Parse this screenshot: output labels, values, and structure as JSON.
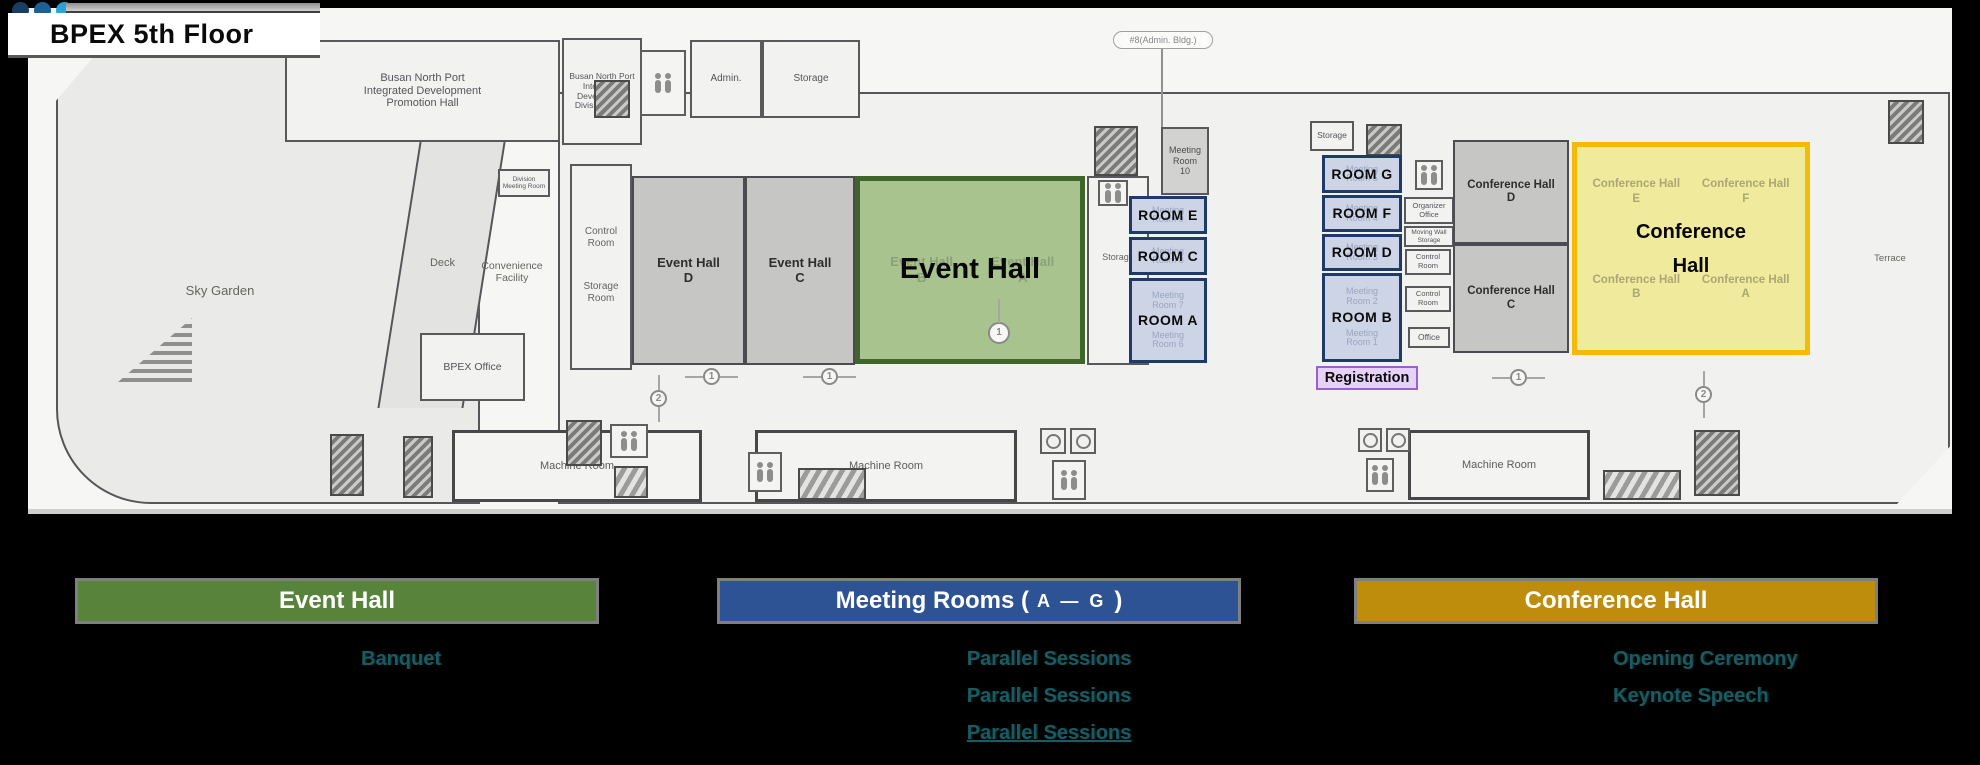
{
  "header": {
    "title": "BPEX 5th Floor",
    "dot_colors": [
      "#1a3e63",
      "#1f5f97",
      "#2da0d8"
    ]
  },
  "plan": {
    "items": [
      {
        "t": "room",
        "n": "promotion-hall",
        "x": 285,
        "y": 40,
        "w": 275,
        "h": 102,
        "fz": 11,
        "label": "Busan North Port\nIntegrated Development\nPromotion Hall"
      },
      {
        "t": "room",
        "n": "division-office",
        "v": "",
        "x": 562,
        "y": 38,
        "w": 80,
        "h": 107,
        "fz": 8.5,
        "label": "Busan North Port\nIntegrated\nDevelopment\nDivision Office"
      },
      {
        "t": "icon",
        "n": "stairs-icon",
        "v": "stairs",
        "x": 594,
        "y": 80,
        "w": 36,
        "h": 38
      },
      {
        "t": "icon",
        "n": "restroom-icon",
        "v": "restroom",
        "x": 640,
        "y": 50,
        "w": 46,
        "h": 66
      },
      {
        "t": "room",
        "n": "admin-room",
        "x": 690,
        "y": 40,
        "w": 72,
        "h": 78,
        "fz": 10,
        "label": "Admin."
      },
      {
        "t": "room",
        "n": "storage-room-top",
        "x": 762,
        "y": 40,
        "w": 98,
        "h": 78,
        "fz": 10,
        "label": "Storage"
      },
      {
        "t": "callout",
        "n": "admin-bldg-callout",
        "x": 1113,
        "y": 31,
        "w": 100,
        "h": 18,
        "fz": 9,
        "label": "#8(Admin. Bldg.)"
      },
      {
        "t": "vline",
        "n": "callout-line",
        "x": 1161,
        "y": 49,
        "w": 2,
        "h": 79
      },
      {
        "t": "room",
        "n": "division-meeting-room",
        "x": 498,
        "y": 169,
        "w": 52,
        "h": 28,
        "fz": 6.5,
        "label": "Division\nMeeting Room"
      },
      {
        "t": "room",
        "n": "control-storage-block",
        "x": 570,
        "y": 164,
        "w": 62,
        "h": 206,
        "fz": 10,
        "label": ""
      },
      {
        "t": "label",
        "n": "control-room-label",
        "x": 572,
        "y": 226,
        "w": 58,
        "fz": 10,
        "label": "Control\nRoom"
      },
      {
        "t": "label",
        "n": "storage-room-label",
        "x": 572,
        "y": 281,
        "w": 58,
        "fz": 10,
        "label": "Storage\nRoom"
      },
      {
        "t": "room",
        "n": "bpex-office",
        "x": 420,
        "y": 333,
        "w": 105,
        "h": 68,
        "fz": 10.5,
        "label": "BPEX Office"
      },
      {
        "t": "label",
        "n": "sky-garden-label",
        "x": 160,
        "y": 284,
        "w": 120,
        "fz": 13,
        "label": "Sky Garden"
      },
      {
        "t": "label",
        "n": "deck-label",
        "x": 415,
        "y": 257,
        "w": 55,
        "fz": 11,
        "label": "Deck"
      },
      {
        "t": "label",
        "n": "convenience-facility-label",
        "x": 462,
        "y": 260,
        "w": 100,
        "fz": 10.5,
        "label": "Convenience\nFacility"
      },
      {
        "t": "room",
        "n": "event-hall-d",
        "v": "gray",
        "x": 632,
        "y": 176,
        "w": 113,
        "h": 189,
        "fz": 13,
        "label": "Event Hall\nD"
      },
      {
        "t": "room",
        "n": "event-hall-c",
        "v": "gray",
        "x": 745,
        "y": 176,
        "w": 110,
        "h": 189,
        "fz": 13,
        "label": "Event Hall\nC"
      },
      {
        "t": "room",
        "n": "storage-mid-room",
        "x": 1087,
        "y": 176,
        "w": 62,
        "h": 189,
        "fz": 9,
        "label": ""
      },
      {
        "t": "label",
        "n": "storage-mid-label",
        "x": 1090,
        "y": 252,
        "w": 56,
        "fz": 9,
        "label": "Storage"
      },
      {
        "t": "overlay",
        "v": "green",
        "n": "event-hall-overlay",
        "x": 855,
        "y": 176,
        "w": 230,
        "h": 188,
        "main": "Event Hall",
        "ghosts": [
          {
            "text": "Event Hall\nB",
            "px": 6,
            "pw": 44
          },
          {
            "text": "Event Hall\nA",
            "px": 52,
            "pw": 44
          }
        ]
      },
      {
        "t": "icon",
        "n": "stairs-icon",
        "v": "stairs",
        "x": 1094,
        "y": 126,
        "w": 44,
        "h": 50
      },
      {
        "t": "icon",
        "n": "elevator-icon",
        "v": "restroom",
        "x": 1098,
        "y": 180,
        "w": 30,
        "h": 26
      },
      {
        "t": "room",
        "n": "meeting-room-10",
        "v": "mid",
        "x": 1161,
        "y": 127,
        "w": 48,
        "h": 68,
        "fz": 9,
        "label": "Meeting\nRoom\n10"
      },
      {
        "t": "roombox",
        "n": "room-e-overlay",
        "x": 1129,
        "y": 196,
        "w": 78,
        "h": 38,
        "label": "ROOM E",
        "ghosts": [
          "Meeting Room 9"
        ]
      },
      {
        "t": "roombox",
        "n": "room-c-overlay",
        "x": 1129,
        "y": 237,
        "w": 78,
        "h": 38,
        "label": "ROOM C",
        "ghosts": [
          "Meeting Room 8"
        ]
      },
      {
        "t": "roombox",
        "n": "room-a-overlay",
        "x": 1129,
        "y": 278,
        "w": 78,
        "h": 85,
        "label": "ROOM A",
        "ghosts": [
          "Meeting Room 7",
          "Meeting Room 6"
        ]
      },
      {
        "t": "room",
        "n": "storage-small",
        "x": 1310,
        "y": 121,
        "w": 44,
        "h": 30,
        "fz": 8.5,
        "label": "Storage"
      },
      {
        "t": "icon",
        "n": "stairs-icon",
        "v": "stairs",
        "x": 1366,
        "y": 124,
        "w": 36,
        "h": 32
      },
      {
        "t": "icon",
        "n": "restroom-icon",
        "v": "restroom",
        "x": 1415,
        "y": 160,
        "w": 28,
        "h": 30
      },
      {
        "t": "room",
        "n": "organizer-office",
        "x": 1404,
        "y": 197,
        "w": 50,
        "h": 27,
        "fz": 7.5,
        "label": "Organizer\nOffice"
      },
      {
        "t": "room",
        "n": "moving-wall-storage",
        "x": 1404,
        "y": 226,
        "w": 50,
        "h": 21,
        "fz": 6.5,
        "label": "Moving Wall\nStorage"
      },
      {
        "t": "room",
        "n": "control-room-a",
        "x": 1405,
        "y": 249,
        "w": 46,
        "h": 26,
        "fz": 7.5,
        "label": "Control\nRoom"
      },
      {
        "t": "room",
        "n": "control-room-b",
        "x": 1405,
        "y": 286,
        "w": 46,
        "h": 26,
        "fz": 7.5,
        "label": "Control\nRoom"
      },
      {
        "t": "room",
        "n": "office-small",
        "x": 1408,
        "y": 327,
        "w": 42,
        "h": 21,
        "fz": 8.5,
        "label": "Office"
      },
      {
        "t": "roombox",
        "n": "room-g-overlay",
        "x": 1322,
        "y": 155,
        "w": 80,
        "h": 38,
        "label": "ROOM G",
        "ghosts": [
          "Meeting Room 5"
        ]
      },
      {
        "t": "roombox",
        "n": "room-f-overlay",
        "x": 1322,
        "y": 195,
        "w": 80,
        "h": 37,
        "label": "ROOM F",
        "ghosts": [
          "Meeting Room 4"
        ]
      },
      {
        "t": "roombox",
        "n": "room-d-overlay",
        "x": 1322,
        "y": 234,
        "w": 80,
        "h": 37,
        "label": "ROOM D",
        "ghosts": [
          "Meeting Room 3"
        ]
      },
      {
        "t": "roombox",
        "n": "room-b-overlay",
        "x": 1322,
        "y": 273,
        "w": 80,
        "h": 89,
        "label": "ROOM B",
        "ghosts": [
          "Meeting Room 2",
          "Meeting Room 1"
        ]
      },
      {
        "t": "registration",
        "n": "registration-overlay",
        "x": 1316,
        "y": 366,
        "w": 102,
        "h": 24,
        "label": "Registration"
      },
      {
        "t": "room",
        "n": "conference-hall-d",
        "v": "gray",
        "x": 1453,
        "y": 140,
        "w": 116,
        "h": 104,
        "fz": 11.5,
        "label": "Conference Hall\nD"
      },
      {
        "t": "room",
        "n": "conference-hall-c",
        "v": "gray",
        "x": 1453,
        "y": 244,
        "w": 116,
        "h": 109,
        "fz": 11.5,
        "label": "Conference Hall\nC"
      },
      {
        "t": "overlay",
        "v": "yellow",
        "n": "conference-hall-overlay",
        "x": 1572,
        "y": 142,
        "w": 238,
        "h": 213,
        "main": "Conference\nHall",
        "ghosts": [
          {
            "text": "Conference Hall\nE",
            "px": 3,
            "py": 15,
            "pw": 46
          },
          {
            "text": "Conference Hall\nF",
            "px": 51,
            "py": 15,
            "pw": 46
          },
          {
            "text": "Conference Hall\nB",
            "px": 3,
            "py": 62,
            "pw": 46
          },
          {
            "text": "Conference Hall\nA",
            "px": 51,
            "py": 62,
            "pw": 46
          }
        ]
      },
      {
        "t": "label",
        "n": "terrace-label",
        "x": 1855,
        "y": 254,
        "w": 70,
        "fz": 9.5,
        "label": "Terrace"
      },
      {
        "t": "room",
        "n": "machine-room-1",
        "v": "mr",
        "x": 452,
        "y": 430,
        "w": 250,
        "h": 72,
        "fz": 11,
        "label": "Machine Room"
      },
      {
        "t": "room",
        "n": "machine-room-2",
        "v": "mr",
        "x": 755,
        "y": 430,
        "w": 262,
        "h": 72,
        "fz": 11,
        "label": "Machine Room"
      },
      {
        "t": "room",
        "n": "machine-room-3",
        "v": "mr",
        "x": 1408,
        "y": 430,
        "w": 182,
        "h": 70,
        "fz": 11,
        "label": "Machine Room"
      },
      {
        "t": "icon",
        "n": "stairs-icon",
        "v": "stairs",
        "x": 330,
        "y": 434,
        "w": 34,
        "h": 62
      },
      {
        "t": "icon",
        "n": "stairs-icon",
        "v": "stairs",
        "x": 403,
        "y": 436,
        "w": 30,
        "h": 62
      },
      {
        "t": "icon",
        "n": "elevator-icon",
        "v": "stairs",
        "x": 566,
        "y": 420,
        "w": 36,
        "h": 46
      },
      {
        "t": "icon",
        "n": "restroom-icon",
        "v": "restroom",
        "x": 610,
        "y": 424,
        "w": 38,
        "h": 34
      },
      {
        "t": "icon",
        "n": "escalator-icon",
        "v": "escalator",
        "x": 614,
        "y": 466,
        "w": 34,
        "h": 32
      },
      {
        "t": "icon",
        "n": "restroom-icon",
        "v": "restroom",
        "x": 748,
        "y": 452,
        "w": 34,
        "h": 40
      },
      {
        "t": "icon",
        "n": "escalator-icon",
        "v": "escalator",
        "x": 798,
        "y": 468,
        "w": 68,
        "h": 32
      },
      {
        "t": "icon",
        "n": "wheelchair-icon",
        "v": "wheel",
        "x": 1040,
        "y": 428,
        "w": 26,
        "h": 26
      },
      {
        "t": "icon",
        "n": "wheelchair-icon",
        "v": "wheel",
        "x": 1070,
        "y": 428,
        "w": 26,
        "h": 26
      },
      {
        "t": "icon",
        "n": "restroom-icon",
        "v": "restroom",
        "x": 1052,
        "y": 460,
        "w": 34,
        "h": 40
      },
      {
        "t": "icon",
        "n": "wheelchair-icon",
        "v": "wheel",
        "x": 1358,
        "y": 428,
        "w": 24,
        "h": 24
      },
      {
        "t": "icon",
        "n": "wheelchair-icon",
        "v": "wheel",
        "x": 1386,
        "y": 428,
        "w": 24,
        "h": 24
      },
      {
        "t": "icon",
        "n": "restroom-icon",
        "v": "restroom",
        "x": 1366,
        "y": 458,
        "w": 28,
        "h": 34
      },
      {
        "t": "icon",
        "n": "escalator-icon",
        "v": "escalator",
        "x": 1603,
        "y": 470,
        "w": 78,
        "h": 30
      },
      {
        "t": "icon",
        "n": "stairs-icon",
        "v": "stairs",
        "x": 1694,
        "y": 430,
        "w": 46,
        "h": 66
      },
      {
        "t": "icon",
        "n": "stairs-icon",
        "v": "stairs",
        "x": 1888,
        "y": 100,
        "w": 36,
        "h": 44
      },
      {
        "t": "marker",
        "n": "corridor-marker-1",
        "x": 703,
        "y": 368,
        "label": "1"
      },
      {
        "t": "marker",
        "n": "corridor-marker-1",
        "x": 821,
        "y": 368,
        "label": "1"
      },
      {
        "t": "marker",
        "n": "corridor-marker-2",
        "v": "vert",
        "x": 650,
        "y": 390,
        "label": "2"
      },
      {
        "t": "marker",
        "n": "corridor-marker-key",
        "v": "big",
        "x": 988,
        "y": 322,
        "label": "1"
      },
      {
        "t": "marker",
        "n": "corridor-marker-1",
        "x": 1510,
        "y": 369,
        "label": "1"
      },
      {
        "t": "marker",
        "n": "corridor-marker-2",
        "v": "vert",
        "x": 1695,
        "y": 386,
        "label": "2"
      }
    ]
  },
  "legend": {
    "items": [
      {
        "name": "event-hall",
        "label": "Event Hall",
        "color": "#57833a",
        "notes": [
          {
            "text": "Banquet"
          }
        ]
      },
      {
        "name": "meeting-rooms",
        "label_pre": "Meeting Rooms (",
        "label_small": "A — G",
        "label_post": ")",
        "color": "#2e5395",
        "notes": [
          {
            "text": "Parallel Sessions"
          },
          {
            "text": "Parallel Sessions"
          },
          {
            "text": "Parallel Sessions",
            "underline": true
          }
        ]
      },
      {
        "name": "conference-hall",
        "label": "Conference Hall",
        "color": "#bd8d0b",
        "notes": [
          {
            "text": "Opening Ceremony"
          },
          {
            "text": "Keynote Speech"
          }
        ]
      }
    ]
  }
}
